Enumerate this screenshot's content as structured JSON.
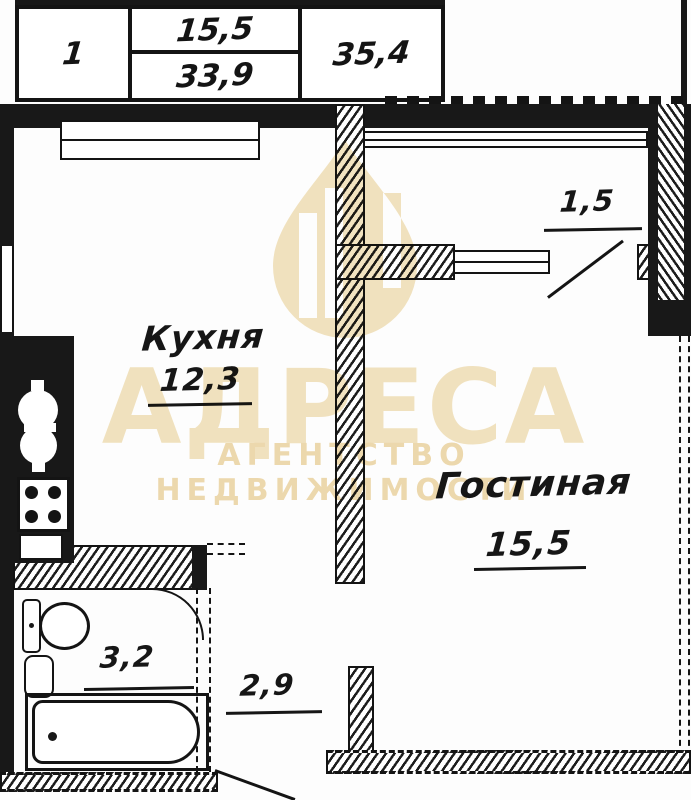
{
  "table": {
    "col1": "1",
    "col2_top": "15,5",
    "col2_bottom": "33,9",
    "col3": "35,4"
  },
  "rooms": {
    "kitchen": {
      "name": "Кухня",
      "area": "12,3"
    },
    "living": {
      "name": "Гостиная",
      "area": "15,5"
    },
    "balcony": {
      "area": "1,5"
    },
    "bathroom": {
      "area": "3,2"
    },
    "hallway": {
      "area": "2,9"
    }
  },
  "watermark": {
    "title": "АДРЕСА",
    "subtitle": "АГЕНТСТВО НЕДВИЖИМОСТИ",
    "color": "#f2e2bd"
  },
  "colors": {
    "ink": "#181818",
    "paper": "#fdfdfd",
    "watermark": "#f2e2bd",
    "watermark_deep": "#eed8ab"
  }
}
